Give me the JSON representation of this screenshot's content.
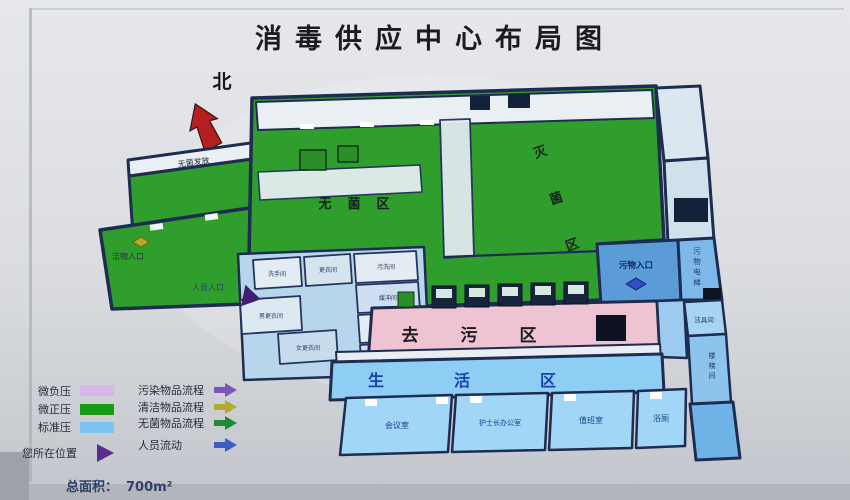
{
  "title": "消毒供应中心布局图",
  "north": {
    "label": "北"
  },
  "plan": {
    "zones": {
      "sterile": "无菌区",
      "sterilization": "灭菌区",
      "decontamination": "去污区",
      "living": "生活区"
    },
    "entrances": {
      "clean": "洁物入口",
      "staff": "人员入口",
      "waste": "污物入口"
    },
    "rooms": {
      "sterile_issue": "无菌发放",
      "washroom": "洗手间",
      "changing": "更衣间",
      "soiled_wash": "污洗间",
      "buffer_a": "缓冲间",
      "tools_a": "洁具间",
      "buffer_b": "缓冲间",
      "male_changing": "男更衣间",
      "female_changing": "女更衣间",
      "waste_elevator": "污物电梯",
      "tools_b": "洁具间",
      "stairs": "楼梯间",
      "meeting": "会议室",
      "head_nurse": "护士长办公室",
      "duty": "值班室",
      "bath": "浴厕"
    }
  },
  "legend": {
    "pressure": [
      {
        "label": "微负压",
        "color": "#d8b6e6"
      },
      {
        "label": "微正压",
        "color": "#149c14"
      },
      {
        "label": "标准压",
        "color": "#7cc3f2"
      }
    ],
    "location": {
      "label": "您所在位置",
      "color": "#5c2d91"
    },
    "flows": [
      {
        "label": "污染物品流程",
        "color": "#7d55b8"
      },
      {
        "label": "清洁物品流程",
        "color": "#b3a92c"
      },
      {
        "label": "无菌物品流程",
        "color": "#1f8c35"
      },
      {
        "label": "人员流动",
        "color": "#3c5cc8"
      }
    ],
    "total_area_label": "总面积：",
    "total_area_value": "700m²"
  }
}
